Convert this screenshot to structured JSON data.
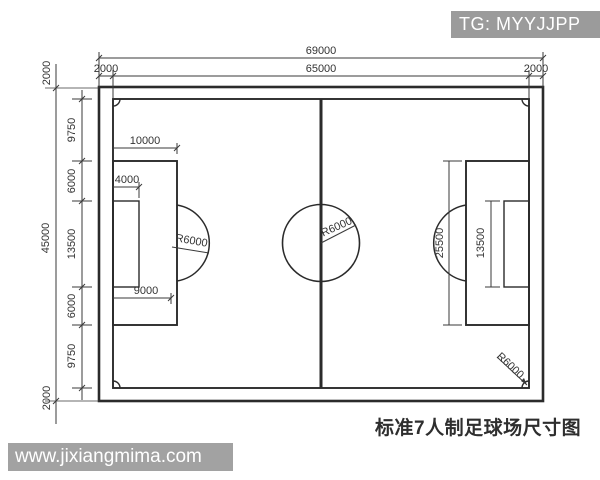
{
  "page": {
    "width": 600,
    "height": 480,
    "background": "#ffffff"
  },
  "watermarks": {
    "telegram_badge": {
      "label": "TG: MYYJJPP",
      "bg_color": "#9b9b9b",
      "text_color": "#ffffff"
    },
    "website_badge": {
      "label": "www.jixiangmima.com",
      "bg_color": "#a2a2a2",
      "text_color": "#ffffff"
    }
  },
  "caption": {
    "text": "标准7人制足球场尺寸图"
  },
  "drawing": {
    "subject": "standard 7-a-side football pitch dimension diagram",
    "line_color": "#2b2b2b",
    "dim_labels": {
      "overall_width": "69000",
      "pitch_width": "65000",
      "margin_top_left": "2000",
      "margin_top_right": "2000",
      "margin_side_top": "2000",
      "margin_side_bottom": "2000",
      "overall_height": "45000",
      "seg_9750_top": "9750",
      "seg_6000_top": "6000",
      "seg_13500": "13500",
      "seg_6000_bottom": "6000",
      "seg_9750_bottom": "9750",
      "penalty_depth": "10000",
      "goal_depth": "4000",
      "penalty_mark": "9000",
      "penalty_area_width": "25500",
      "goal_area_width": "13500",
      "center_circle_radius": "R6000",
      "penalty_arc_radius": "R6000",
      "corner_arc_radius": "R6000"
    }
  }
}
